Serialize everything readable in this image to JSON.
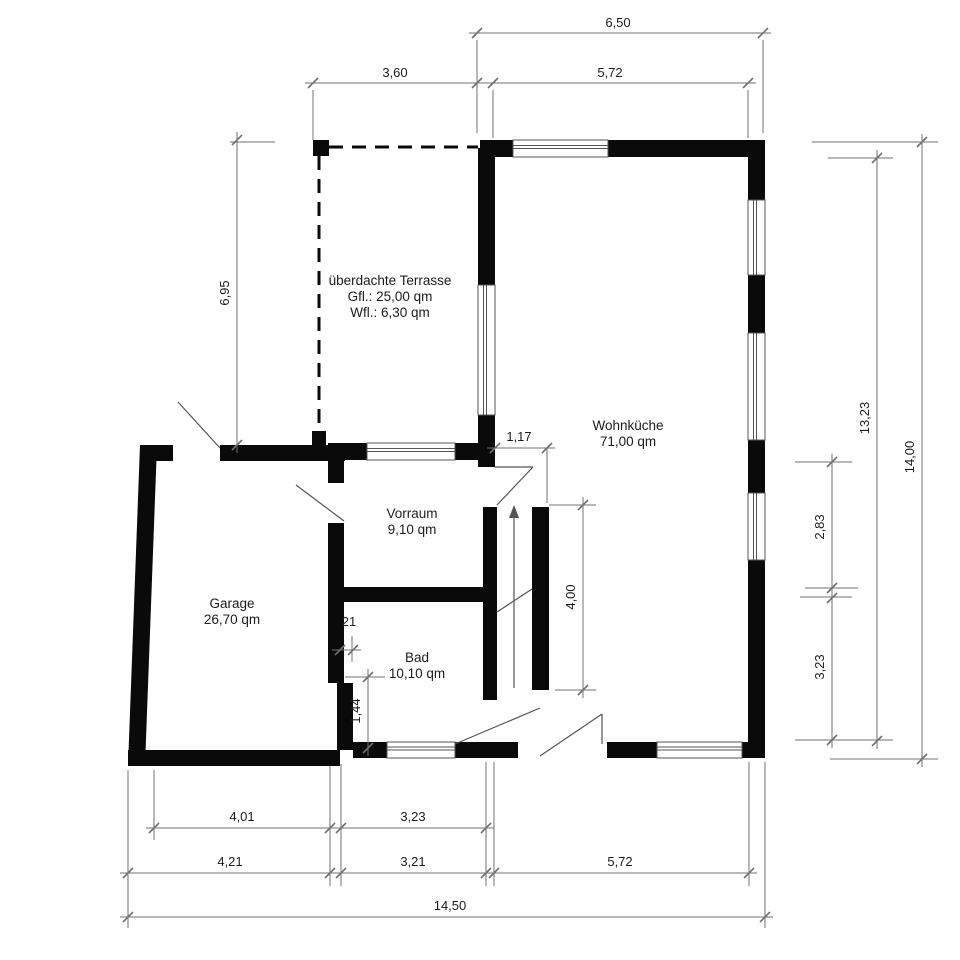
{
  "plan": {
    "canvas": {
      "width": 960,
      "height": 960,
      "background": "#ffffff"
    },
    "colors": {
      "wall": "#0a0a0a",
      "dim_line": "#707070",
      "text": "#1c1c1c",
      "thin_line": "#555555"
    },
    "rooms": [
      {
        "name": "ueberdachte-terrasse",
        "lines": [
          "überdachte Terrasse",
          "Gfl.: 25,00 qm",
          "Wfl.: 6,30 qm"
        ],
        "x": 390,
        "y": 285
      },
      {
        "name": "wohnkueche",
        "lines": [
          "Wohnküche",
          "71,00 qm"
        ],
        "x": 628,
        "y": 430
      },
      {
        "name": "vorraum",
        "lines": [
          "Vorraum",
          "9,10 qm"
        ],
        "x": 412,
        "y": 518
      },
      {
        "name": "garage",
        "lines": [
          "Garage",
          "26,70 qm"
        ],
        "x": 232,
        "y": 608
      },
      {
        "name": "bad",
        "lines": [
          "Bad",
          "10,10 qm"
        ],
        "x": 417,
        "y": 662
      }
    ],
    "walls": [
      {
        "x": 480,
        "y": 140,
        "w": 33,
        "h": 17
      },
      {
        "x": 608,
        "y": 140,
        "w": 157,
        "h": 17
      },
      {
        "x": 748,
        "y": 140,
        "w": 17,
        "h": 60
      },
      {
        "x": 748,
        "y": 275,
        "w": 17,
        "h": 58
      },
      {
        "x": 748,
        "y": 440,
        "w": 17,
        "h": 53
      },
      {
        "x": 748,
        "y": 560,
        "w": 17,
        "h": 198
      },
      {
        "x": 607,
        "y": 742,
        "w": 50,
        "h": 16
      },
      {
        "x": 742,
        "y": 742,
        "w": 23,
        "h": 16
      },
      {
        "x": 455,
        "y": 742,
        "w": 63,
        "h": 16
      },
      {
        "x": 353,
        "y": 742,
        "w": 34,
        "h": 16
      },
      {
        "x": 128,
        "y": 750,
        "w": 212,
        "h": 16
      },
      {
        "x": 140,
        "y": 445,
        "w": 33,
        "h": 16
      },
      {
        "x": 220,
        "y": 445,
        "w": 125,
        "h": 16
      },
      {
        "x": 328,
        "y": 461,
        "w": 16,
        "h": 22
      },
      {
        "x": 328,
        "y": 523,
        "w": 16,
        "h": 160
      },
      {
        "x": 337,
        "y": 683,
        "w": 16,
        "h": 67
      },
      {
        "x": 328,
        "y": 443,
        "w": 39,
        "h": 17
      },
      {
        "x": 455,
        "y": 443,
        "w": 40,
        "h": 17
      },
      {
        "x": 478,
        "y": 148,
        "w": 17,
        "h": 137
      },
      {
        "x": 478,
        "y": 415,
        "w": 17,
        "h": 52
      },
      {
        "x": 330,
        "y": 587,
        "w": 165,
        "h": 15
      },
      {
        "x": 483,
        "y": 507,
        "w": 14,
        "h": 193
      },
      {
        "x": 532,
        "y": 507,
        "w": 17,
        "h": 183
      },
      {
        "x": 313,
        "y": 140,
        "w": 16,
        "h": 16
      },
      {
        "x": 312,
        "y": 431,
        "w": 14,
        "h": 14
      }
    ],
    "wall_polygons": [
      {
        "points": "140,445 157,445 145,766 128,766"
      }
    ],
    "windows": [
      {
        "x": 513,
        "y": 140,
        "w": 95,
        "h": 17,
        "orient": "h"
      },
      {
        "x": 748,
        "y": 200,
        "w": 17,
        "h": 75,
        "orient": "v"
      },
      {
        "x": 748,
        "y": 333,
        "w": 17,
        "h": 107,
        "orient": "v"
      },
      {
        "x": 748,
        "y": 493,
        "w": 17,
        "h": 67,
        "orient": "v"
      },
      {
        "x": 657,
        "y": 742,
        "w": 85,
        "h": 16,
        "orient": "h"
      },
      {
        "x": 387,
        "y": 742,
        "w": 68,
        "h": 16,
        "orient": "h"
      },
      {
        "x": 367,
        "y": 443,
        "w": 88,
        "h": 17,
        "orient": "h"
      },
      {
        "x": 478,
        "y": 285,
        "w": 17,
        "h": 130,
        "orient": "v"
      }
    ],
    "dashed_lines": [
      {
        "x1": 329,
        "y1": 147,
        "x2": 478,
        "y2": 147
      },
      {
        "x1": 319,
        "y1": 156,
        "x2": 319,
        "y2": 431
      }
    ],
    "door_lines": [
      {
        "x1": 220,
        "y1": 448,
        "x2": 178,
        "y2": 402
      },
      {
        "x1": 344,
        "y1": 521,
        "x2": 296,
        "y2": 485
      },
      {
        "x1": 495,
        "y1": 467,
        "x2": 533,
        "y2": 467
      },
      {
        "x1": 533,
        "y1": 467,
        "x2": 497,
        "y2": 505
      },
      {
        "x1": 455,
        "y1": 744,
        "x2": 540,
        "y2": 708
      },
      {
        "x1": 540,
        "y1": 756,
        "x2": 602,
        "y2": 714
      },
      {
        "x1": 602,
        "y1": 714,
        "x2": 602,
        "y2": 744
      },
      {
        "x1": 497,
        "y1": 612,
        "x2": 532,
        "y2": 589
      }
    ],
    "stair_arrow": {
      "x1": 514,
      "y1": 688,
      "x2": 514,
      "y2": 516,
      "head": "514,505 509,518 519,518"
    },
    "dimensions": [
      {
        "label": "6,50",
        "x1": 477,
        "y1": 33,
        "x2": 763,
        "y2": 33,
        "lx": 618,
        "ly": 27,
        "rot": false
      },
      {
        "label": "3,60",
        "x1": 313,
        "y1": 83,
        "x2": 477,
        "y2": 83,
        "lx": 395,
        "ly": 77,
        "rot": false
      },
      {
        "label": "5,72",
        "x1": 493,
        "y1": 83,
        "x2": 748,
        "y2": 83,
        "lx": 610,
        "ly": 77,
        "rot": false
      },
      {
        "label": "6,95",
        "x1": 237,
        "y1": 140,
        "x2": 237,
        "y2": 445,
        "lx": 229,
        "ly": 293,
        "rot": true
      },
      {
        "label": "13,23",
        "x1": 877,
        "y1": 158,
        "x2": 877,
        "y2": 741,
        "lx": 869,
        "ly": 418,
        "rot": true
      },
      {
        "label": "14,00",
        "x1": 922,
        "y1": 142,
        "x2": 922,
        "y2": 759,
        "lx": 914,
        "ly": 457,
        "rot": true
      },
      {
        "label": "2,83",
        "x1": 832,
        "y1": 462,
        "x2": 832,
        "y2": 588,
        "lx": 824,
        "ly": 527,
        "rot": true
      },
      {
        "label": "3,23",
        "x1": 832,
        "y1": 598,
        "x2": 832,
        "y2": 740,
        "lx": 824,
        "ly": 667,
        "rot": true
      },
      {
        "label": "1,17",
        "x1": 495,
        "y1": 448,
        "x2": 547,
        "y2": 448,
        "lx": 519,
        "ly": 441,
        "rot": false
      },
      {
        "label": "4,00",
        "x1": 583,
        "y1": 505,
        "x2": 583,
        "y2": 690,
        "lx": 575,
        "ly": 597,
        "rot": true
      },
      {
        "label": "21",
        "x1": 340,
        "y1": 650,
        "x2": 353,
        "y2": 650,
        "lx": 349,
        "ly": 626,
        "rot": false
      },
      {
        "label": "1,44",
        "x1": 368,
        "y1": 677,
        "x2": 368,
        "y2": 748,
        "lx": 360,
        "ly": 711,
        "rot": true
      },
      {
        "label": "4,01",
        "x1": 154,
        "y1": 828,
        "x2": 330,
        "y2": 828,
        "lx": 242,
        "ly": 821,
        "rot": false
      },
      {
        "label": "3,23",
        "x1": 341,
        "y1": 828,
        "x2": 486,
        "y2": 828,
        "lx": 413,
        "ly": 821,
        "rot": false
      },
      {
        "label": "4,21",
        "x1": 128,
        "y1": 873,
        "x2": 330,
        "y2": 873,
        "lx": 230,
        "ly": 866,
        "rot": false
      },
      {
        "label": "3,21",
        "x1": 341,
        "y1": 873,
        "x2": 486,
        "y2": 873,
        "lx": 413,
        "ly": 866,
        "rot": false
      },
      {
        "label": "5,72",
        "x1": 494,
        "y1": 873,
        "x2": 749,
        "y2": 873,
        "lx": 620,
        "ly": 866,
        "rot": false
      },
      {
        "label": "14,50",
        "x1": 128,
        "y1": 917,
        "x2": 765,
        "y2": 917,
        "lx": 450,
        "ly": 910,
        "rot": false
      }
    ],
    "extension_lines": [
      {
        "x1": 477,
        "y1": 40,
        "x2": 477,
        "y2": 133
      },
      {
        "x1": 763,
        "y1": 40,
        "x2": 763,
        "y2": 133
      },
      {
        "x1": 313,
        "y1": 90,
        "x2": 313,
        "y2": 140
      },
      {
        "x1": 493,
        "y1": 90,
        "x2": 493,
        "y2": 138
      },
      {
        "x1": 748,
        "y1": 90,
        "x2": 748,
        "y2": 138
      },
      {
        "x1": 230,
        "y1": 142,
        "x2": 275,
        "y2": 142
      },
      {
        "x1": 828,
        "y1": 158,
        "x2": 893,
        "y2": 158
      },
      {
        "x1": 812,
        "y1": 142,
        "x2": 938,
        "y2": 142
      },
      {
        "x1": 795,
        "y1": 462,
        "x2": 852,
        "y2": 462
      },
      {
        "x1": 805,
        "y1": 588,
        "x2": 858,
        "y2": 588
      },
      {
        "x1": 800,
        "y1": 597,
        "x2": 852,
        "y2": 597
      },
      {
        "x1": 795,
        "y1": 740,
        "x2": 893,
        "y2": 740
      },
      {
        "x1": 830,
        "y1": 759,
        "x2": 938,
        "y2": 759
      },
      {
        "x1": 547,
        "y1": 448,
        "x2": 547,
        "y2": 503
      },
      {
        "x1": 549,
        "y1": 505,
        "x2": 596,
        "y2": 505
      },
      {
        "x1": 555,
        "y1": 690,
        "x2": 596,
        "y2": 690
      },
      {
        "x1": 345,
        "y1": 677,
        "x2": 385,
        "y2": 677
      },
      {
        "x1": 345,
        "y1": 748,
        "x2": 385,
        "y2": 748
      },
      {
        "x1": 343,
        "y1": 636,
        "x2": 343,
        "y2": 662
      },
      {
        "x1": 352,
        "y1": 636,
        "x2": 352,
        "y2": 662
      },
      {
        "x1": 128,
        "y1": 770,
        "x2": 128,
        "y2": 928
      },
      {
        "x1": 154,
        "y1": 770,
        "x2": 154,
        "y2": 840
      },
      {
        "x1": 330,
        "y1": 764,
        "x2": 330,
        "y2": 886
      },
      {
        "x1": 341,
        "y1": 764,
        "x2": 341,
        "y2": 886
      },
      {
        "x1": 486,
        "y1": 762,
        "x2": 486,
        "y2": 886
      },
      {
        "x1": 494,
        "y1": 762,
        "x2": 494,
        "y2": 886
      },
      {
        "x1": 749,
        "y1": 762,
        "x2": 749,
        "y2": 886
      },
      {
        "x1": 765,
        "y1": 762,
        "x2": 765,
        "y2": 928
      }
    ]
  }
}
